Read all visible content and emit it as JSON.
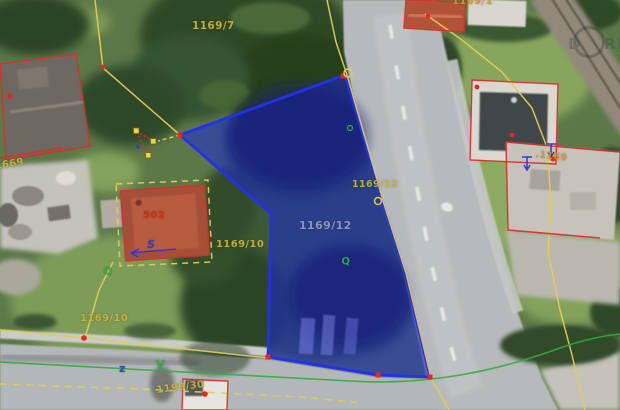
{
  "colors": {
    "selection_fill": "#1b24d8",
    "selection_stroke": "#2330ee",
    "boundary_yellow": "#e2cc52",
    "building_outline_red": "#d63127",
    "vertex_red": "#e8281c",
    "label_yellow": "#c8b13e",
    "label_orange": "#d2952f",
    "label_gray_blue": "#9fa5c0",
    "label_red": "#d82a16",
    "green_overlay": "#2fae3e",
    "blue_symbol": "#2b3ec8"
  },
  "map": {
    "description": "aerial cadastral map with selected parcel highlighted in blue",
    "selected_parcel": "1169/12",
    "parcel_labels": {
      "p1169_7": "1169/7",
      "p1169_1": "1169/1",
      "p1169_13": "1169/13",
      "p1169_12": "1169/12",
      "p1169_10_east": "1169/10",
      "p1169_10_west": "1169/10",
      "b502": "502",
      "b1669": ".1669",
      "b1169": ".1169",
      "p1199_30": "1199/30"
    },
    "overlay_symbols": {
      "s_marker": "S",
      "z_marker": "z",
      "v_marker": "V",
      "tree_marker_1": "Q",
      "tree_marker_2": "Q"
    },
    "watermark": {
      "left": "D",
      "right": "RIS"
    }
  }
}
